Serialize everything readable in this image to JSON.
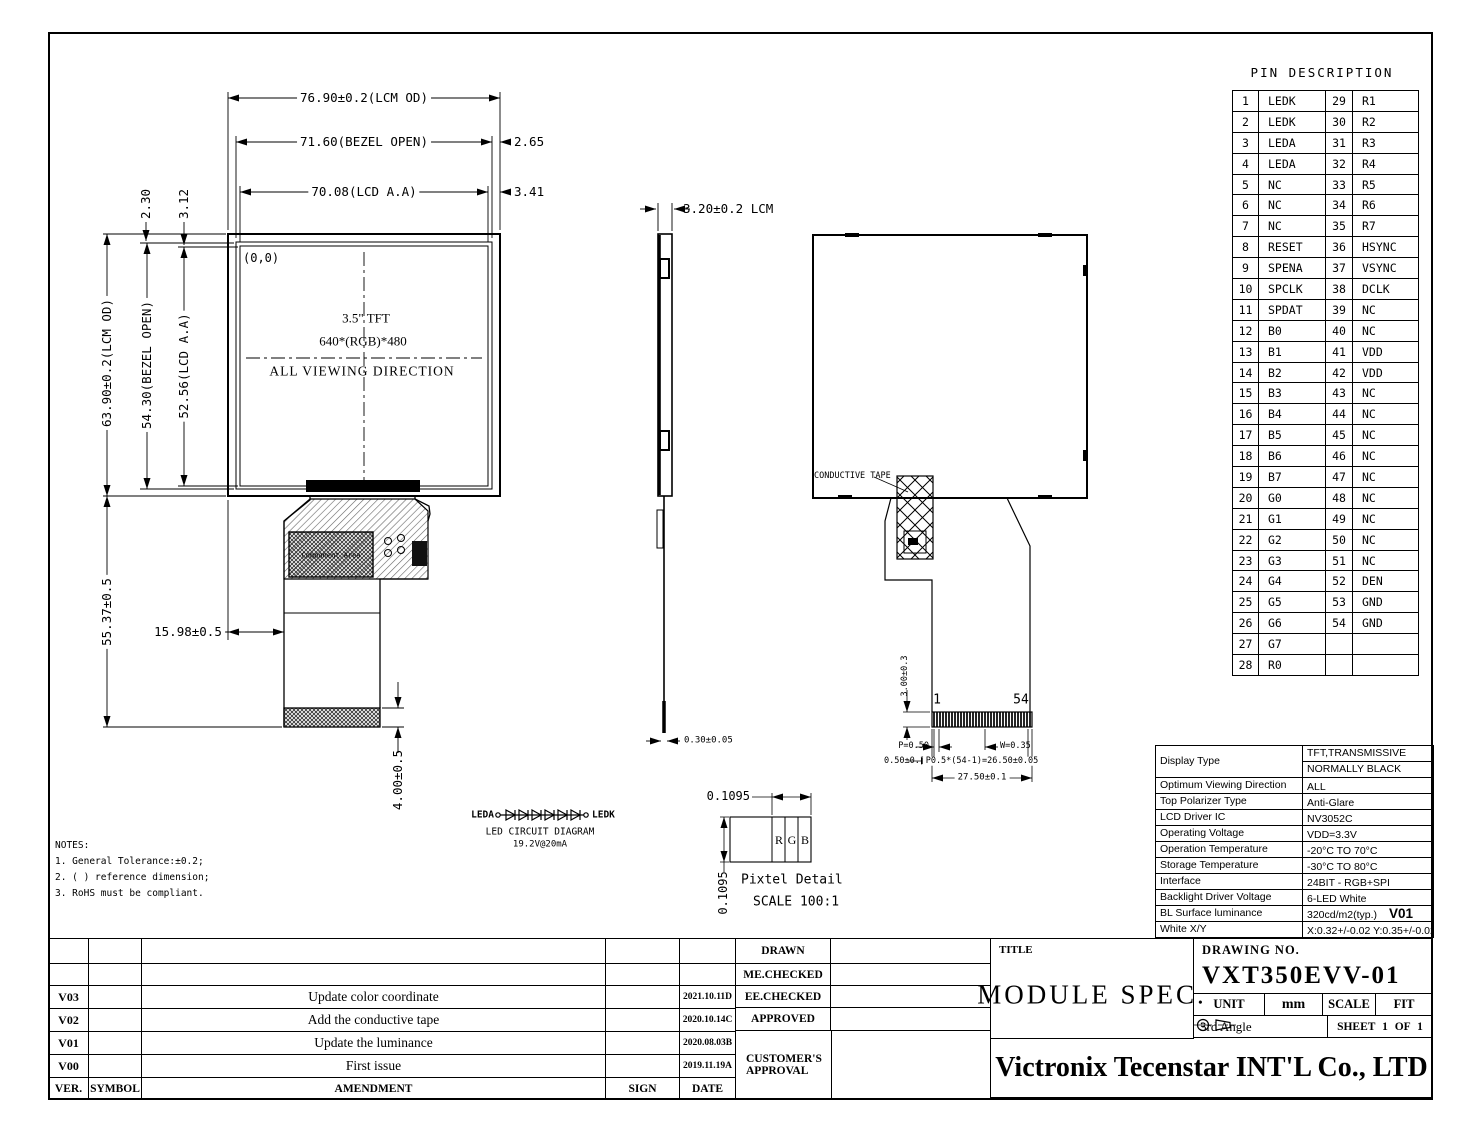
{
  "front_view": {
    "origin": "(0,0)",
    "panel_line1": "3.5\" TFT",
    "panel_line2": "640*(RGB)*480",
    "panel_line3": "ALL VIEWING DIRECTION",
    "component_area": "Component Area",
    "dims": {
      "lcm_w": "76.90±0.2(LCM OD)",
      "bezel_w": "71.60(BEZEL OPEN)",
      "aa_w": "70.08(LCD A.A)",
      "right_bezel": "2.65",
      "right_aa": "3.41",
      "top_bezel": "2.30",
      "top_aa": "3.12",
      "lcm_h": "63.90±0.2(LCM OD)",
      "bezel_h": "54.30(BEZEL OPEN)",
      "aa_h": "52.56(LCD A.A)",
      "fpc_len": "55.37±0.5",
      "fpc_offset": "15.98±0.5",
      "tail": "4.00±0.5"
    }
  },
  "side_view": {
    "thickness": "3.20±0.2 LCM",
    "tail": "0.30±0.05"
  },
  "back_view": {
    "tape": "CONDUCTIVE TAPE",
    "pin_first": "1",
    "pin_last": "54",
    "contact_h": "3.00±0.3",
    "pitch": "P=0.50",
    "width": "W=0.35",
    "margin": "0.50±0.1",
    "span": "P0.5*(54-1)=26.50±0.05",
    "total": "27.50±0.1"
  },
  "led_circuit": {
    "anode": "LEDA",
    "cathode": "LEDK",
    "title": "LED CIRCUIT DIAGRAM",
    "rating": "19.2V@20mA"
  },
  "pixel_detail": {
    "dim_w": "0.1095",
    "dim_h": "0.1095",
    "r": "R",
    "g": "G",
    "b": "B",
    "title": "Pixtel Detail",
    "scale": "SCALE 100:1"
  },
  "notes": {
    "title": "NOTES:",
    "items": [
      "1. General Tolerance:±0.2;",
      "2. ( ) reference dimension;",
      "3. RoHS must be compliant."
    ]
  },
  "pin_table": {
    "title": "PIN DESCRIPTION",
    "rows": [
      {
        "n1": "1",
        "p1": "LEDK",
        "n2": "29",
        "p2": "R1"
      },
      {
        "n1": "2",
        "p1": "LEDK",
        "n2": "30",
        "p2": "R2"
      },
      {
        "n1": "3",
        "p1": "LEDA",
        "n2": "31",
        "p2": "R3"
      },
      {
        "n1": "4",
        "p1": "LEDA",
        "n2": "32",
        "p2": "R4"
      },
      {
        "n1": "5",
        "p1": "NC",
        "n2": "33",
        "p2": "R5"
      },
      {
        "n1": "6",
        "p1": "NC",
        "n2": "34",
        "p2": "R6"
      },
      {
        "n1": "7",
        "p1": "NC",
        "n2": "35",
        "p2": "R7"
      },
      {
        "n1": "8",
        "p1": "RESET",
        "n2": "36",
        "p2": "HSYNC"
      },
      {
        "n1": "9",
        "p1": "SPENA",
        "n2": "37",
        "p2": "VSYNC"
      },
      {
        "n1": "10",
        "p1": "SPCLK",
        "n2": "38",
        "p2": "DCLK"
      },
      {
        "n1": "11",
        "p1": "SPDAT",
        "n2": "39",
        "p2": "NC"
      },
      {
        "n1": "12",
        "p1": "B0",
        "n2": "40",
        "p2": "NC"
      },
      {
        "n1": "13",
        "p1": "B1",
        "n2": "41",
        "p2": "VDD"
      },
      {
        "n1": "14",
        "p1": "B2",
        "n2": "42",
        "p2": "VDD"
      },
      {
        "n1": "15",
        "p1": "B3",
        "n2": "43",
        "p2": "NC"
      },
      {
        "n1": "16",
        "p1": "B4",
        "n2": "44",
        "p2": "NC"
      },
      {
        "n1": "17",
        "p1": "B5",
        "n2": "45",
        "p2": "NC"
      },
      {
        "n1": "18",
        "p1": "B6",
        "n2": "46",
        "p2": "NC"
      },
      {
        "n1": "19",
        "p1": "B7",
        "n2": "47",
        "p2": "NC"
      },
      {
        "n1": "20",
        "p1": "G0",
        "n2": "48",
        "p2": "NC"
      },
      {
        "n1": "21",
        "p1": "G1",
        "n2": "49",
        "p2": "NC"
      },
      {
        "n1": "22",
        "p1": "G2",
        "n2": "50",
        "p2": "NC"
      },
      {
        "n1": "23",
        "p1": "G3",
        "n2": "51",
        "p2": "NC"
      },
      {
        "n1": "24",
        "p1": "G4",
        "n2": "52",
        "p2": "DEN"
      },
      {
        "n1": "25",
        "p1": "G5",
        "n2": "53",
        "p2": "GND"
      },
      {
        "n1": "26",
        "p1": "G6",
        "n2": "54",
        "p2": "GND"
      },
      {
        "n1": "27",
        "p1": "G7",
        "n2": "",
        "p2": ""
      },
      {
        "n1": "28",
        "p1": "R0",
        "n2": "",
        "p2": ""
      }
    ]
  },
  "spec_table": {
    "display_type_label": "Display Type",
    "display_type_1": "TFT,TRANSMISSIVE",
    "display_type_2": "NORMALLY BLACK",
    "rows": [
      {
        "label": "Optimum Viewing Direction",
        "value": "ALL"
      },
      {
        "label": "Top Polarizer Type",
        "value": "Anti-Glare"
      },
      {
        "label": "LCD Driver IC",
        "value": "NV3052C"
      },
      {
        "label": "Operating Voltage",
        "value": "VDD=3.3V"
      },
      {
        "label": "Operation Temperature",
        "value": "-20°C TO 70°C"
      },
      {
        "label": "Storage Temperature",
        "value": "-30°C TO 80°C"
      },
      {
        "label": "Interface",
        "value": "24BIT - RGB+SPI"
      },
      {
        "label": "Backlight Driver Voltage",
        "value": "6-LED White"
      },
      {
        "label": "BL Surface luminance",
        "value": "320cd/m2(typ.)",
        "badge": "V01"
      },
      {
        "label": "White X/Y",
        "value": "X:0.32+/-0.02 Y:0.35+/-0.02"
      }
    ]
  },
  "revision_table": {
    "headers": {
      "ver": "VER.",
      "symbol": "SYMBOL",
      "amendment": "AMENDMENT",
      "sign": "SIGN",
      "date": "DATE"
    },
    "rows": [
      {
        "ver": "V03",
        "amendment": "Update color coordinate",
        "date": "2021.10.11D"
      },
      {
        "ver": "V02",
        "amendment": "Add the conductive tape",
        "date": "2020.10.14C"
      },
      {
        "ver": "V01",
        "amendment": "Update the luminance",
        "date": "2020.08.03B"
      },
      {
        "ver": "V00",
        "amendment": "First issue",
        "date": "2019.11.19A"
      }
    ]
  },
  "approval": {
    "drawn": "DRAWN",
    "me_checked": "ME.CHECKED",
    "ee_checked": "EE.CHECKED",
    "approved": "APPROVED",
    "customer": "CUSTOMER'S APPROVAL"
  },
  "title_block": {
    "title_label": "TITLE",
    "title": "MODULE SPEC.",
    "drawing_no_label": "DRAWING NO.",
    "drawing_no": "VXT350EVV-01",
    "unit_label": "UNIT",
    "unit": "mm",
    "scale_label": "SCALE",
    "scale": "FIT",
    "angle": "3rd Angle",
    "sheet": "SHEET 1 OF 1",
    "company": "Victronix Tecenstar INT'L Co., LTD"
  }
}
